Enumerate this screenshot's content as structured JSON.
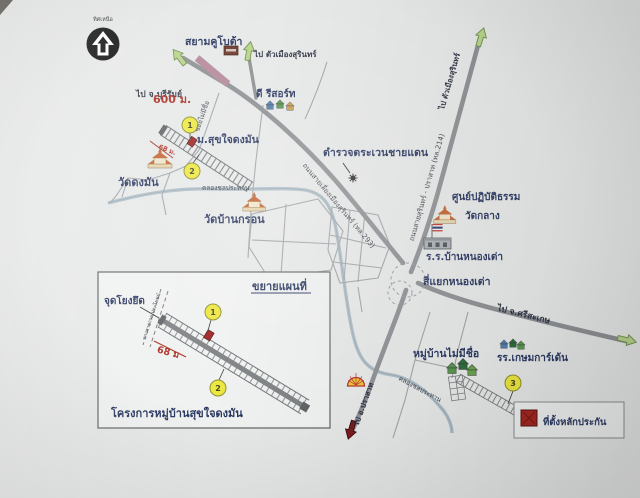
{
  "compass": {
    "label": "ทิศเหนือ"
  },
  "places": {
    "siam_kubota": "สยามคูโบต้า",
    "d_resort": "ดี รีสอร์ท",
    "mu_sukjai_dongman": "ม.สุขใจดงมัน",
    "wat_dongman": "วัดดงมัน",
    "wat_bankron": "วัดบ้านกรอน",
    "border_patrol": "ตำรวจตระเวนชายแดน",
    "dhamma_center": "ศูนย์ปฏิบัติธรรม",
    "wat_klang": "วัดกลาง",
    "school_nongtao": "ร.ร.บ้านหนองเต่า",
    "nongtao_intersection": "สี่แยกหนองเต่า",
    "village_noname": "หมู่บ้านไม่มีชื่อ",
    "kasem_garden_school": "รร.เกษมการ์เด้น"
  },
  "directions": {
    "to_buriram": "ไป จ.บุรีรัมย์",
    "to_surin_city": "ไป ตัวเมืองสุรินทร์",
    "to_surin_city_214": "ไป ตัวเมืองสุรินทร์",
    "to_sisaket": "ไป จ.ศรีสะเกษ",
    "to_prasat": "ไป อ.ปราสาท"
  },
  "roads": {
    "bypass_293": "ถนนสายเลี่ยงเมืองสุรินทร์ (ทล.293)",
    "highway_214": "ถนนสายสุรินทร์ - ปราสาท (ทล.214)",
    "soi_noname": "ซอยไม่มีชื่อ",
    "canal_west": "คลองชลประทาน",
    "canal_south": "คลองชลประทาน"
  },
  "distances": {
    "kubota_600m": "600 ม.",
    "strip_68m": "68 ม.",
    "inset_68m": "68 ม"
  },
  "markers": {
    "m1": "1",
    "m2": "2",
    "m3": "3",
    "inset_m1": "1",
    "inset_m2": "2"
  },
  "inset": {
    "title": "ขยายแผนที่",
    "anchor_point": "จุดโยงยึด",
    "public_way": "ทางสาธารณประโยชน์",
    "project_name": "โครงการหมู่บ้านสุขใจดงมัน"
  },
  "legend": {
    "collateral_site": "ที่ตั้งหลักประกัน"
  },
  "colors": {
    "label_navy": "#2a3760",
    "road_gray": "#8e9194",
    "canal_blue": "#aebdc6",
    "marker_yellow": "#ece73e",
    "arrow_green": "#b9d48c",
    "highlight_pink": "#b5899b",
    "collateral_red": "#a62721",
    "distance_red": "#ab2e22"
  }
}
